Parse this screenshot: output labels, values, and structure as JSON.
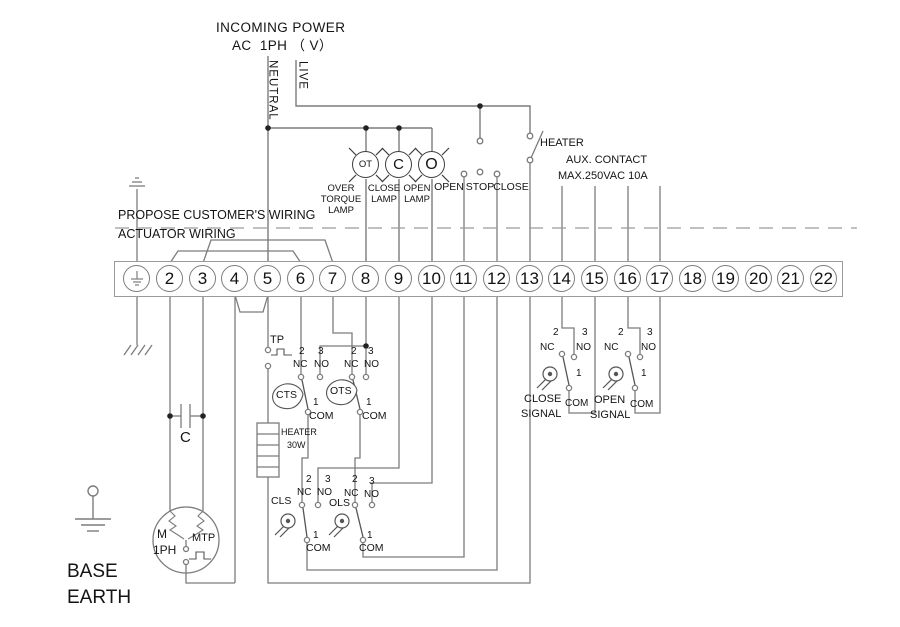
{
  "power": {
    "line1": "INCOMING POWER",
    "line2": "AC  1PH （ V）",
    "neutral": "NEUTRAL",
    "live": "LIVE"
  },
  "top": {
    "heater": "HEATER",
    "aux_line1": "AUX. CONTACT",
    "aux_line2": "MAX.250VAC 10A",
    "open": "OPEN",
    "stop": "STOP",
    "close": "CLOSE"
  },
  "lamps": {
    "ot": "OT",
    "c": "C",
    "o": "O",
    "ot_l1": "OVER",
    "ot_l2": "TORQUE",
    "ot_l3": "LAMP",
    "c_l1": "CLOSE",
    "c_l2": "LAMP",
    "o_l1": "OPEN",
    "o_l2": "LAMP"
  },
  "boundary": {
    "customer": "PROPOSE CUSTOMER'S WIRING",
    "actuator": "ACTUATOR WIRING"
  },
  "strip": {
    "numbers": [
      "2",
      "3",
      "4",
      "5",
      "6",
      "7",
      "8",
      "9",
      "10",
      "11",
      "12",
      "13",
      "14",
      "15",
      "16",
      "17",
      "18",
      "19",
      "20",
      "21",
      "22"
    ]
  },
  "sw": {
    "tp": "TP",
    "cts": "CTS",
    "ots": "OTS",
    "cls": "CLS",
    "ols": "OLS",
    "nc": "NC",
    "no": "NO",
    "com": "COM",
    "n1": "1",
    "n2": "2",
    "n3": "3"
  },
  "heater30w": {
    "l1": "HEATER",
    "l2": "30W"
  },
  "cap": "C",
  "motor": {
    "m": "M",
    "ph": "1PH",
    "mtp": "MTP"
  },
  "base": {
    "l1": "BASE",
    "l2": "EARTH"
  },
  "signals": {
    "close_l1": "CLOSE",
    "close_l2": "SIGNAL",
    "open_l1": "OPEN",
    "open_l2": "SIGNAL"
  },
  "colors": {
    "wire": "#7c7c7c",
    "symbol": "#555555",
    "text": "#141414",
    "dashed": "#9a9a9a"
  }
}
